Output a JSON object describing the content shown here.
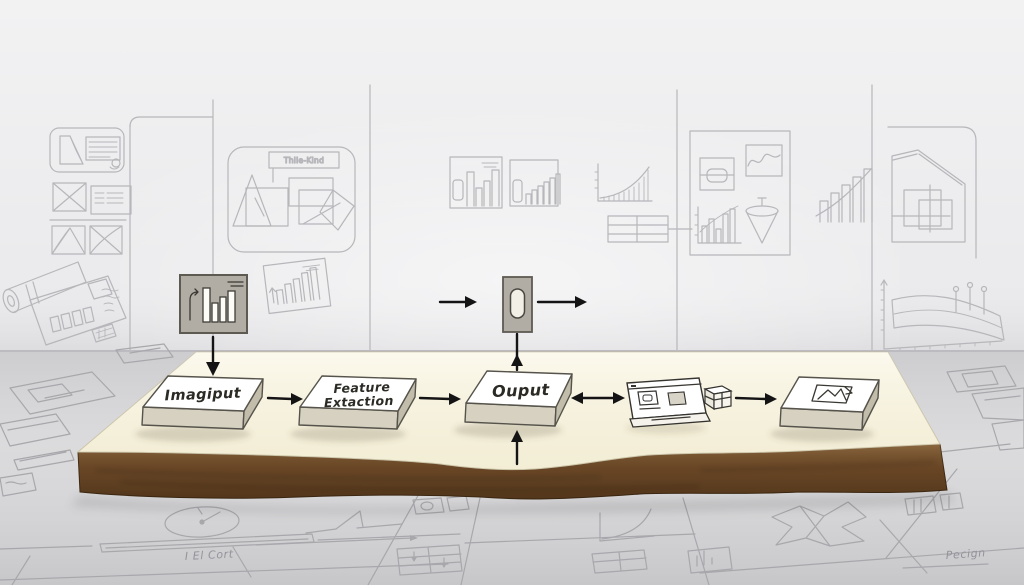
{
  "pipeline": {
    "stage1_label": "Imagiput",
    "stage2_line1": "Feature",
    "stage2_line2": "Extaction",
    "stage3_label": "Ouput"
  },
  "wall": {
    "panel_title": "Thile-Kind"
  },
  "floor": {
    "left_note": "I El Cort",
    "right_note": "Pecign"
  },
  "icons": {
    "input_box": "bar-chart-icon",
    "middle_widget": "toggle-icon",
    "after_output_1": "browser-window-icon",
    "after_output_2": "package-box-icon",
    "result_slab": "picture-icon"
  },
  "colors": {
    "wall": "#ebebed",
    "floor": "#d7d7d9",
    "platform_top": "#faf6e4",
    "platform_soil": "#6e4a28",
    "slab_top": "#ffffff",
    "slab_side": "#c9c3b1",
    "panel_gray": "#b2ada4",
    "arrow": "#141414",
    "sketch_line": "#b7b7bb"
  }
}
